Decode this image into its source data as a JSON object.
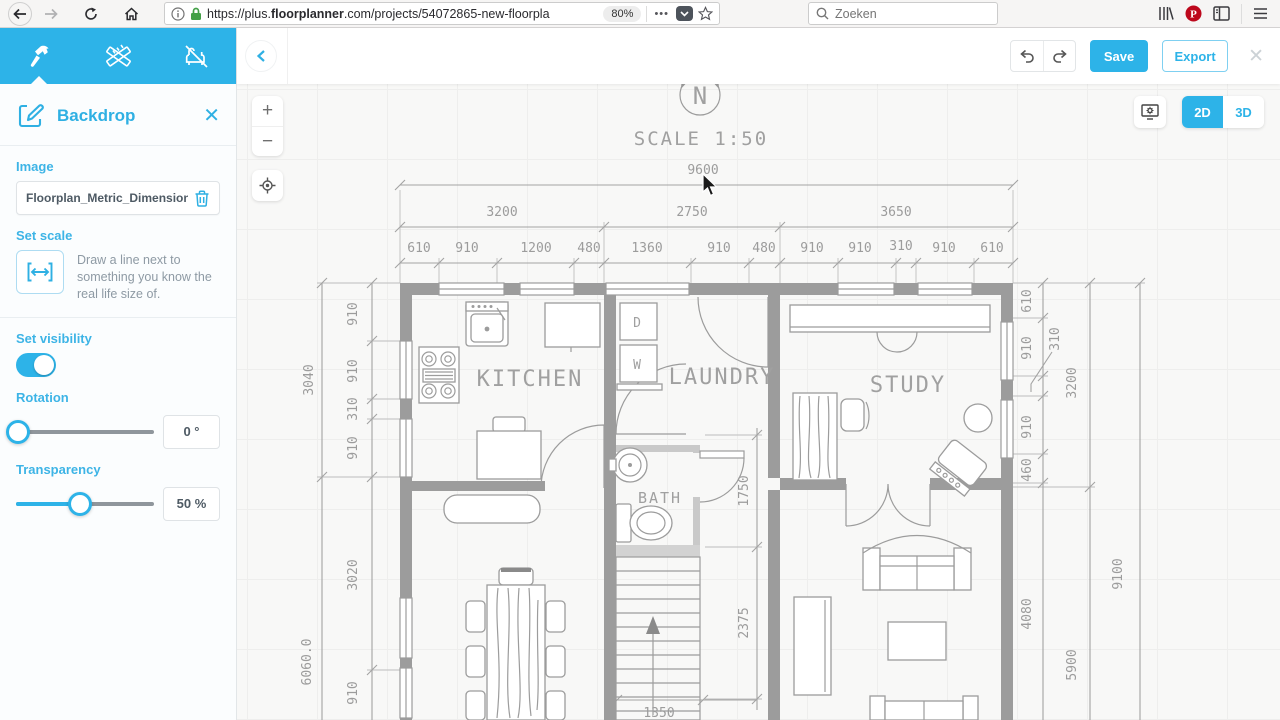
{
  "browser": {
    "url_host": "https://plus.floorplanner.",
    "url_host2": "floorplanner",
    "url_full": "https://plus.floorplanner.com/projects/54072865-new-floorplan",
    "url_prefix": "https://plus.",
    "url_bold": "floorplanner",
    "url_rest": ".com/projects/54072865-new-floorpla",
    "zoom_badge": "80%",
    "more_dots": "•••",
    "search_placeholder": "Zoeken"
  },
  "toolbar": {
    "save": "Save",
    "export": "Export",
    "close": "✕"
  },
  "view": {
    "two_d": "2D",
    "three_d": "3D"
  },
  "zoom_controls": {
    "in": "+",
    "out": "−"
  },
  "sidebar": {
    "title": "Backdrop",
    "close": "✕",
    "image": {
      "label": "Image",
      "value": "Floorplan_Metric_Dimensions..."
    },
    "set_scale": {
      "label": "Set scale",
      "help": "Draw a line next to something you know the real life size of."
    },
    "visibility_label": "Set visibility",
    "rotation": {
      "label": "Rotation",
      "value": "0 °"
    },
    "transparency": {
      "label": "Transparency",
      "value": "50 %"
    }
  },
  "floorplan": {
    "compass_letter": "N",
    "dim_labels": [
      {
        "t": "9600",
        "x": 703,
        "y": 174
      },
      {
        "t": "3200",
        "x": 502,
        "y": 216
      },
      {
        "t": "2750",
        "x": 692,
        "y": 216
      },
      {
        "t": "3650",
        "x": 896,
        "y": 216
      },
      {
        "t": "610",
        "x": 419,
        "y": 252
      },
      {
        "t": "910",
        "x": 467,
        "y": 252
      },
      {
        "t": "1200",
        "x": 536,
        "y": 252
      },
      {
        "t": "480",
        "x": 589,
        "y": 252
      },
      {
        "t": "1360",
        "x": 647,
        "y": 252
      },
      {
        "t": "910",
        "x": 719,
        "y": 252
      },
      {
        "t": "480",
        "x": 764,
        "y": 252
      },
      {
        "t": "910",
        "x": 812,
        "y": 252
      },
      {
        "t": "910",
        "x": 860,
        "y": 252
      },
      {
        "t": "310",
        "x": 901,
        "y": 250
      },
      {
        "t": "910",
        "x": 944,
        "y": 252
      },
      {
        "t": "610",
        "x": 992,
        "y": 252
      },
      {
        "t": "3040",
        "x": 313,
        "y": 380,
        "r": -90
      },
      {
        "t": "6060.0",
        "x": 311,
        "y": 662,
        "r": -90
      },
      {
        "t": "910",
        "x": 357,
        "y": 314,
        "r": -90
      },
      {
        "t": "910",
        "x": 357,
        "y": 371,
        "r": -90
      },
      {
        "t": "310",
        "x": 357,
        "y": 409,
        "r": -90
      },
      {
        "t": "910",
        "x": 357,
        "y": 448,
        "r": -90
      },
      {
        "t": "3020",
        "x": 357,
        "y": 575,
        "r": -90
      },
      {
        "t": "910",
        "x": 357,
        "y": 693,
        "r": -90
      },
      {
        "t": "610",
        "x": 1031,
        "y": 301,
        "r": -90
      },
      {
        "t": "910",
        "x": 1031,
        "y": 348,
        "r": -90
      },
      {
        "t": "310",
        "x": 1059,
        "y": 339,
        "r": -90
      },
      {
        "t": "910",
        "x": 1031,
        "y": 427,
        "r": -90
      },
      {
        "t": "460",
        "x": 1031,
        "y": 470,
        "r": -90
      },
      {
        "t": "4080",
        "x": 1031,
        "y": 614,
        "r": -90
      },
      {
        "t": "3200",
        "x": 1076,
        "y": 383,
        "r": -90
      },
      {
        "t": "5900",
        "x": 1076,
        "y": 665,
        "r": -90
      },
      {
        "t": "9100",
        "x": 1122,
        "y": 574,
        "r": -90
      },
      {
        "t": "1750",
        "x": 748,
        "y": 491,
        "r": -90
      },
      {
        "t": "2375",
        "x": 748,
        "y": 623,
        "r": -90
      },
      {
        "t": "1350",
        "x": 659,
        "y": 717
      }
    ],
    "room_labels": [
      {
        "t": "KITCHEN",
        "x": 530,
        "y": 386,
        "s": 22
      },
      {
        "t": "LAUNDRY",
        "x": 722,
        "y": 384,
        "s": 22
      },
      {
        "t": "STUDY",
        "x": 908,
        "y": 392,
        "s": 22
      },
      {
        "t": "BATH",
        "x": 660,
        "y": 503,
        "s": 15
      },
      {
        "t": "D",
        "x": 638,
        "y": 327,
        "s": 13
      },
      {
        "t": "W",
        "x": 638,
        "y": 369,
        "s": 13
      },
      {
        "t": "SCALE  1:50",
        "x": 701,
        "y": 145,
        "s": 19
      }
    ]
  },
  "colors": {
    "accent": "#2db3e8",
    "plan_gray": "#9c9c9c",
    "pinterest_red": "#bd081c",
    "lock_green": "#43a047"
  }
}
